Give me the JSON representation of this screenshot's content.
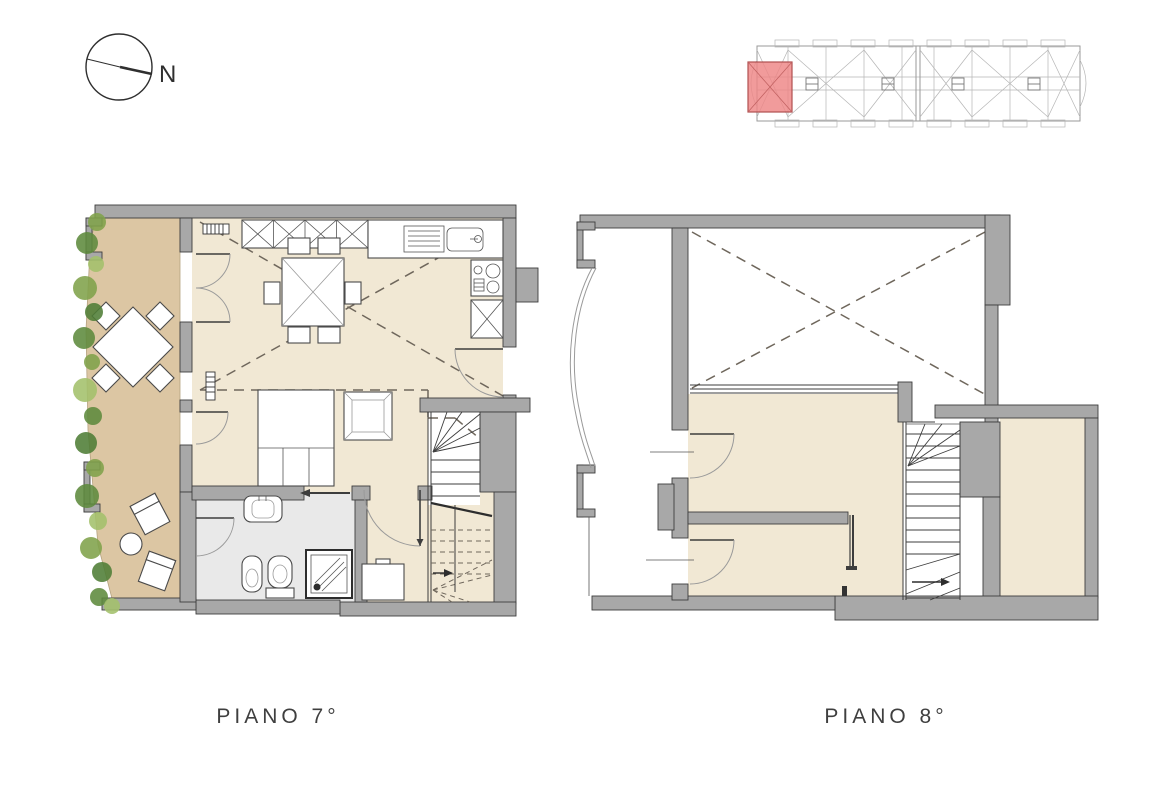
{
  "compass": {
    "label": "N"
  },
  "floor_plans": [
    {
      "id": "piano-7",
      "label": "PIANO 7°"
    },
    {
      "id": "piano-8",
      "label": "PIANO 8°"
    }
  ],
  "key_plan": {
    "description": "building-overview-key-plan",
    "highlighted_unit_color": "#ee8585"
  },
  "icons": {
    "compass": "north-compass",
    "stairs": "staircase-symbol",
    "shower": "shower-symbol",
    "toilet": "toilet-symbol",
    "bidet": "bidet-symbol",
    "washbasin": "washbasin-symbol",
    "bed": "double-bed-symbol",
    "dining_table": "dining-table-symbol",
    "terrace_table": "terrace-table-symbol",
    "wardrobe": "wardrobe-x-symbol",
    "sink": "kitchen-sink-symbol",
    "stove": "stove-symbol",
    "foliage": "plant-foliage"
  },
  "colors": {
    "wall_fill": "#a8a8a8",
    "wall_stroke": "#3d3d3d",
    "terrace_floor": "#dcc6a3",
    "interior_floor": "#f1e8d4",
    "bathroom_floor": "#e9e9e9",
    "dashed_line": "#6f675c",
    "label_text": "#3f3f3f",
    "highlight_red": "#ee8585",
    "keyplan_line": "#9a9a9a",
    "foliage": [
      "#7fa24a",
      "#5d8a3c",
      "#a3c06b",
      "#4e7d35"
    ]
  }
}
